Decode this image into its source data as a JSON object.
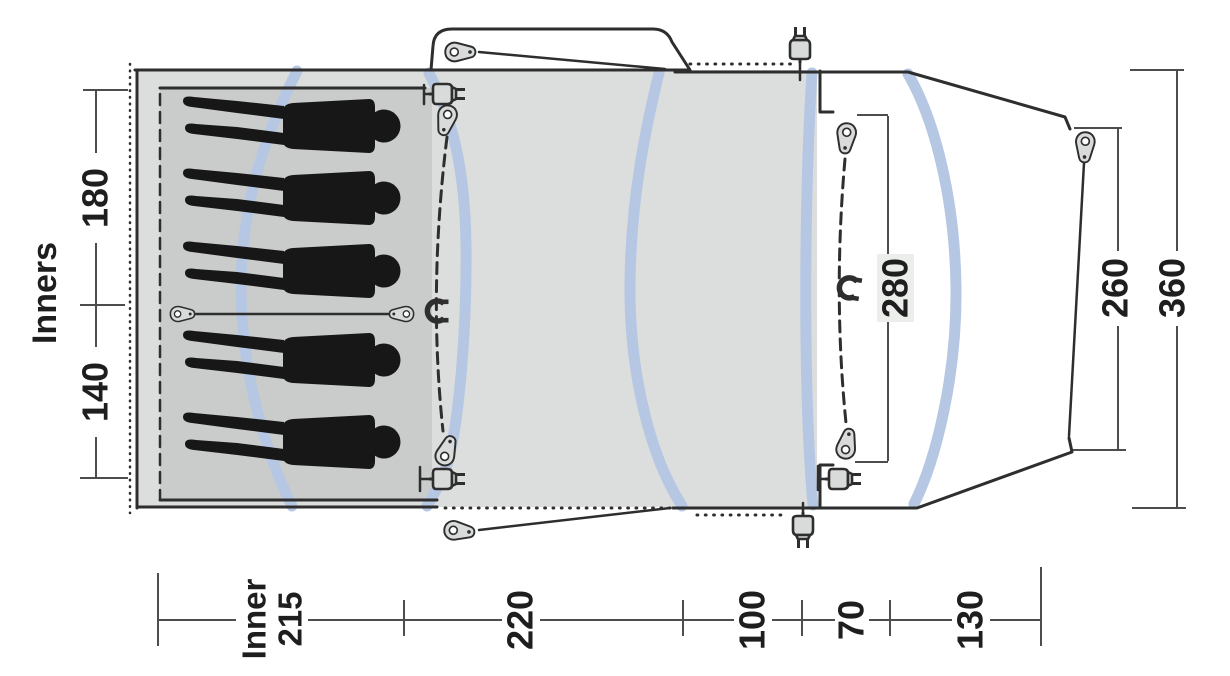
{
  "diagram": {
    "type": "tent-floorplan-top-view",
    "labels": {
      "inners_title": "Inners",
      "inner_section_top": "180",
      "inner_section_bottom": "140",
      "door_opening": "280",
      "front_edge": "260",
      "total_width": "360",
      "bottom_inner_word": "Inner",
      "bottom_inner_value": "215",
      "bottom_living": "220",
      "bottom_front_a": "100",
      "bottom_front_b": "70",
      "bottom_porch": "130"
    },
    "measurements_cm": {
      "inner_width_sections": [
        180,
        140
      ],
      "inner_depth": 215,
      "living_area_depth": 220,
      "front_depth_a": 100,
      "front_depth_b": 70,
      "porch_depth": 130,
      "door_opening_width": 280,
      "front_edge_width": 260,
      "total_width": 360
    },
    "icons": {
      "sleeper_silhouettes": 5,
      "pole_arcs": 5,
      "guy_pegs": 7,
      "divider_toggles": 2,
      "cable_entries": 5,
      "magnet_tiebacks": 2
    },
    "colors": {
      "background": "#ffffff",
      "outline": "#2e2e2e",
      "dimension": "#4d4d4d",
      "pole": "#b6c7e3",
      "living_fill": "#dcdedd",
      "inner_fill": "#c9cccb",
      "silhouette": "#171717",
      "hardware_fill": "#d9dbda",
      "label_bg": "#eceeec"
    }
  }
}
